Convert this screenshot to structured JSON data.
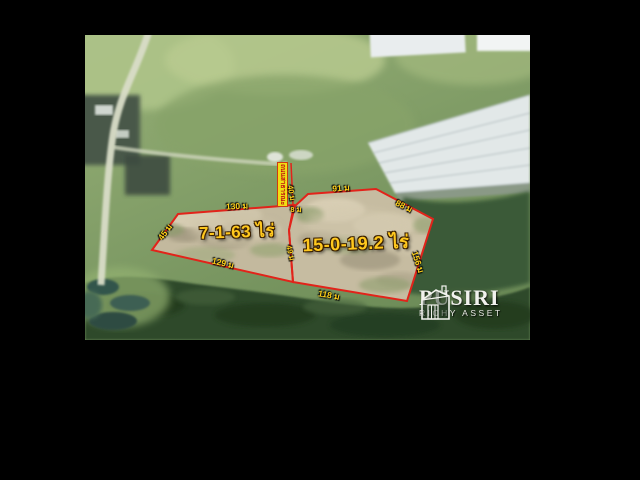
{
  "watermark": {
    "brand": "PUSIRI",
    "tagline": "RICHY ASSET"
  },
  "plots": {
    "left": {
      "area": "7-1-63 ไร่",
      "side_top": "130 ม",
      "side_left": "45 ม",
      "side_bottom": "129 ม"
    },
    "right": {
      "area": "15-0-19.2 ไร่",
      "side_top_left": "91 ม",
      "side_top_right": "88 ม",
      "side_right": "156 ม",
      "side_bottom": "118 ม"
    },
    "divider": {
      "upper": "40 ม",
      "lower": "49 ม"
    }
  },
  "road": {
    "name": "ถนนสาธารณะ",
    "width": "8 ม"
  },
  "colors": {
    "boundary_red": "#e2231a",
    "label_yellow": "#ffd019",
    "road_strip_yellow": "#f1de14"
  }
}
